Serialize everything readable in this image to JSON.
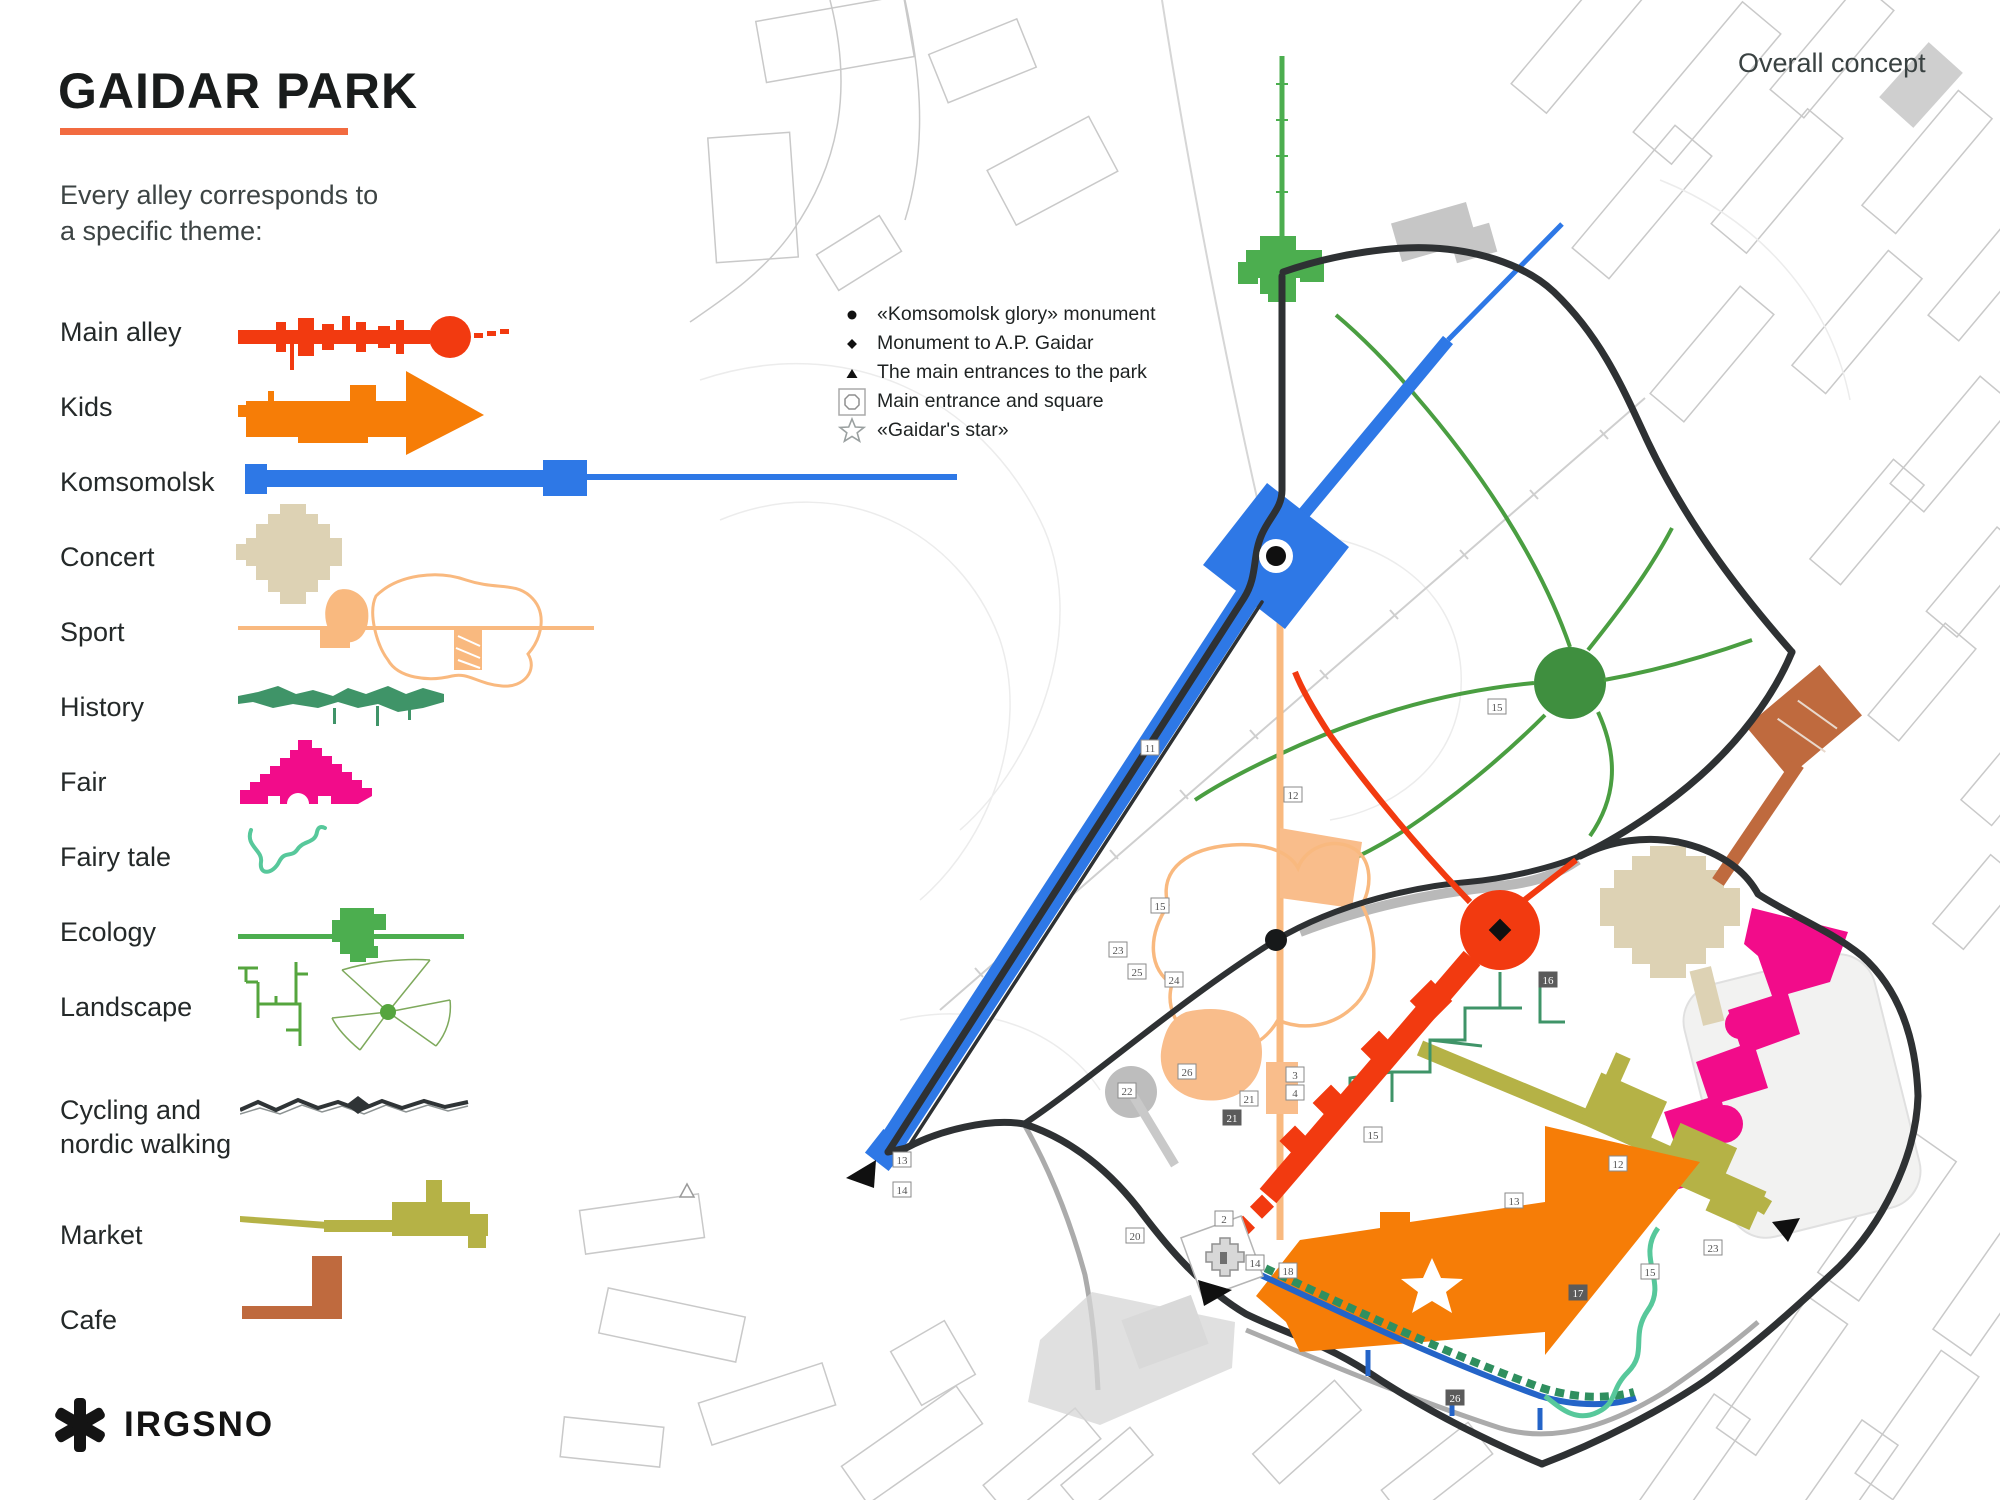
{
  "header": {
    "title": "GAIDAR PARK",
    "subtitle_line1": "Every alley corresponds to",
    "subtitle_line2": "a specific theme:",
    "corner_label": "Overall concept"
  },
  "theme_legend": {
    "items": [
      {
        "id": "main-alley",
        "label": "Main alley",
        "color": "#f23a10"
      },
      {
        "id": "kids",
        "label": "Kids",
        "color": "#f67d07"
      },
      {
        "id": "komsomolsk",
        "label": "Komsomolsk",
        "color": "#2e78e6"
      },
      {
        "id": "concert",
        "label": "Concert",
        "color": "#ddd2b4"
      },
      {
        "id": "sport",
        "label": "Sport",
        "color": "#f9b97f"
      },
      {
        "id": "history",
        "label": "History",
        "color": "#3f9468"
      },
      {
        "id": "fair",
        "label": "Fair",
        "color": "#f20c8a"
      },
      {
        "id": "fairy-tale",
        "label": "Fairy tale",
        "color": "#57c89b"
      },
      {
        "id": "ecology",
        "label": "Ecology",
        "color": "#4cae4f"
      },
      {
        "id": "landscape",
        "label": "Landscape",
        "color": "#55a53e",
        "color2": "#7ea95c"
      },
      {
        "id": "cycling",
        "label_line1": "Cycling and",
        "label_line2": "nordic walking",
        "color": "#2f3436"
      },
      {
        "id": "market",
        "label": "Market",
        "color": "#b5b246"
      },
      {
        "id": "cafe",
        "label": "Cafe",
        "color": "#bf6a3e"
      }
    ]
  },
  "map_legend": {
    "items": [
      {
        "marker": "dot-icon",
        "label": "«Komsomolsk glory» monument"
      },
      {
        "marker": "diamond-icon",
        "label": "Monument to A.P. Gaidar"
      },
      {
        "marker": "triangle-icon",
        "label": "The main entrances to the park"
      },
      {
        "marker": "entrance-square-icon",
        "label": "Main entrance and square"
      },
      {
        "marker": "star-icon",
        "label": "«Gaidar's star»"
      }
    ]
  },
  "brand": {
    "name": "IRGSNO"
  },
  "map": {
    "badges": [
      "11",
      "12",
      "15",
      "23",
      "25",
      "24",
      "26",
      "22",
      "21",
      "21",
      "15",
      "3",
      "4",
      "2",
      "20",
      "14",
      "18",
      "13",
      "14",
      "15",
      "16",
      "12",
      "17",
      "15",
      "23",
      "13",
      "26"
    ]
  },
  "colors": {
    "accent_underline": "#f26b40",
    "park_road": "#2e3133",
    "city_fabric": "#c5c5c5",
    "pond": "#f2f2f1",
    "gray_road": "#9e9e9e"
  }
}
